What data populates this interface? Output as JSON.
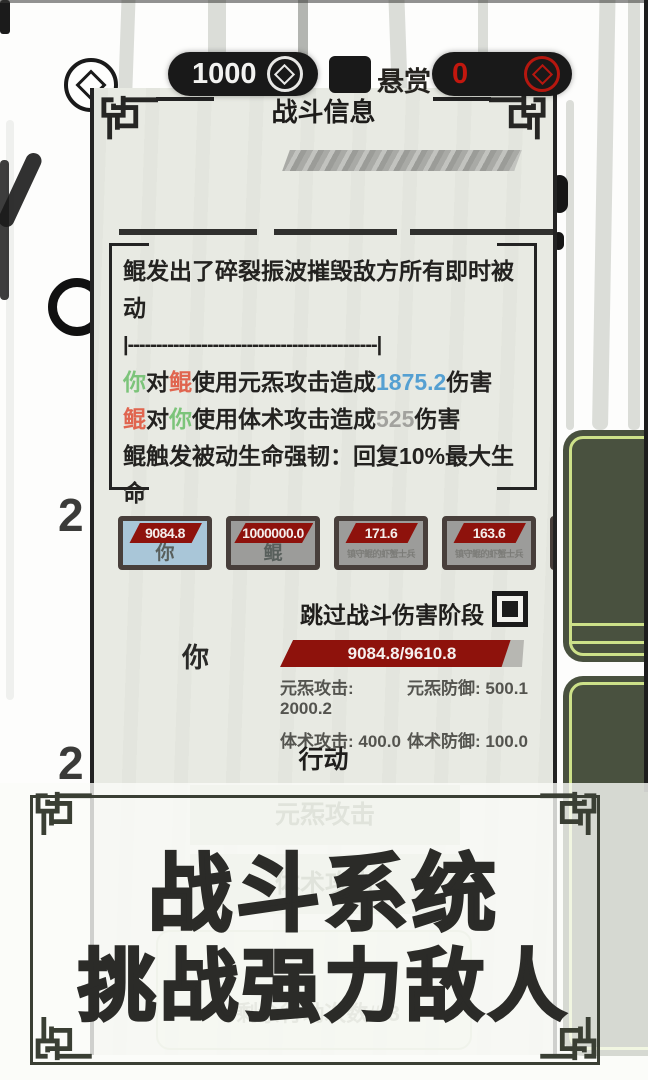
{
  "top_bar": {
    "currency_value": "1000",
    "bounty_label": "悬赏",
    "bounty_value": "0"
  },
  "background": {
    "page_number_1": "2",
    "page_number_2": "2"
  },
  "dialog": {
    "title": "战斗信息",
    "log": {
      "line1": "鲲发出了碎裂振波摧毁敌方所有即时被动",
      "separator": "|--------------------------------------------|",
      "atk1": {
        "actor": "你",
        "link": "对",
        "target": "鲲",
        "mid": "使用元炁攻击造成",
        "value": "1875.2",
        "suffix": "伤害"
      },
      "atk2": {
        "actor": "鲲",
        "link": "对",
        "target": "你",
        "mid": "使用体术攻击造成",
        "value": "525",
        "suffix": "伤害"
      },
      "line4": "鲲触发被动生命强韧：回复10%最大生命"
    },
    "combatants": [
      {
        "hp": "9084.8",
        "name": "你",
        "selected": true
      },
      {
        "hp": "1000000.0",
        "name": "鲲",
        "selected": false
      },
      {
        "hp": "171.6",
        "name": "镇守鲲的虾蟹士兵",
        "selected": false
      },
      {
        "hp": "163.6",
        "name": "镇守鲲的虾蟹士兵",
        "selected": false
      }
    ],
    "skip_label": "跳过战斗伤害阶段",
    "skip_checked": true,
    "player": {
      "name": "你",
      "hp_text": "9084.8/9610.8",
      "hp_percent": 94.5,
      "stats": [
        "元炁攻击: 2000.2",
        "元炁防御: 500.1",
        "体术攻击: 400.0",
        "体术防御: 100.0"
      ]
    },
    "action_title": "行动",
    "action_buttons": [
      {
        "label": "元炁攻击"
      },
      {
        "label": "体术攻击"
      }
    ],
    "remaining_actions": "#剩余行动次数#:3"
  },
  "overlay": {
    "title_line1": "战斗系统",
    "title_line2": "挑战强力敌人"
  },
  "colors": {
    "actor_you_green": "#7cc47a",
    "actor_foe_red": "#e0654f",
    "damage_blue": "#55a0d2",
    "damage_gray": "#a2a29e",
    "hp_red": "#8e120c",
    "selected_card_blue": "#a9c6d8",
    "dialog_bg": "#e8eae3",
    "frame_dark": "#3a3f34",
    "side_button_green": "#49513f",
    "side_button_stroke": "#cde189",
    "bounty_value_red": "#c2170e"
  }
}
